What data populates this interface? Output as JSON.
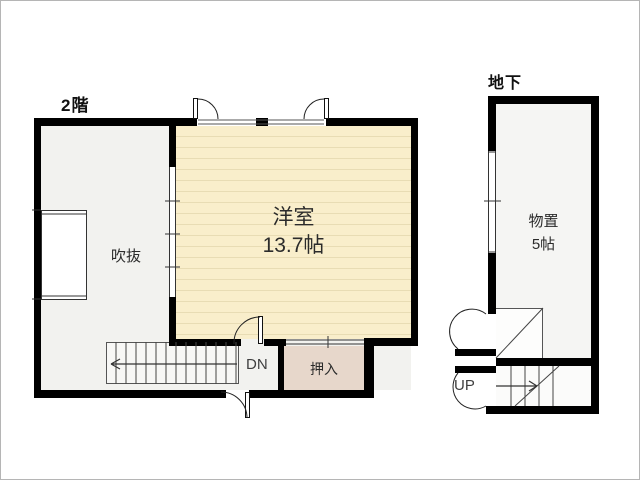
{
  "second_floor": {
    "label": "2階",
    "room_main": {
      "name": "洋室",
      "size": "13.7帖"
    },
    "void_area": {
      "name": "吹抜"
    },
    "closet": {
      "name": "押入"
    },
    "stairs_label": "DN"
  },
  "basement": {
    "label": "地下",
    "storage": {
      "name": "物置",
      "size": "5帖"
    },
    "stairs_label": "UP"
  },
  "colors": {
    "wall": "#000000",
    "wood_floor": "#f9eecb",
    "wood_floor_line": "#e8dcb4",
    "closet_fill": "#e7d7cb",
    "hall_fill": "#f2f2ef",
    "basement_fill": "#f5f5f3",
    "line": "#333333"
  }
}
